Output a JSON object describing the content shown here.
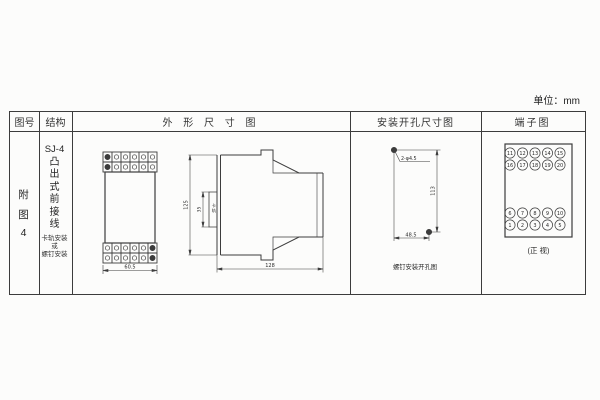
{
  "unit_label": "单位：mm",
  "table": {
    "headers": {
      "fig_no": "图号",
      "structure": "结构",
      "outline": "外 形 尺 寸 图",
      "mounting": "安装开孔尺寸图",
      "terminal": "端子图"
    }
  },
  "fig_no": {
    "chars": [
      "附",
      "图",
      "4"
    ]
  },
  "structure": {
    "model": "SJ-4",
    "type_chars": [
      "凸",
      "出",
      "式",
      "前",
      "接",
      "线"
    ],
    "mount_note": [
      "卡轨安装",
      "或",
      "螺钉安装"
    ]
  },
  "outline": {
    "front_width": "60.5",
    "height": "125",
    "rail_width": "35",
    "rail_label_chars": [
      "卡",
      "轨"
    ],
    "depth": "128"
  },
  "mounting": {
    "hole_label": "2-φ4.5",
    "v_dim": "113",
    "h_dim": "48.5",
    "caption": "螺钉安装开孔图"
  },
  "terminal": {
    "rows": [
      [
        "11",
        "12",
        "13",
        "14",
        "15"
      ],
      [
        "16",
        "17",
        "18",
        "19",
        "20"
      ],
      [
        "6",
        "7",
        "8",
        "9",
        "10"
      ],
      [
        "1",
        "2",
        "3",
        "4",
        "5"
      ]
    ],
    "caption": "(正 视)"
  }
}
